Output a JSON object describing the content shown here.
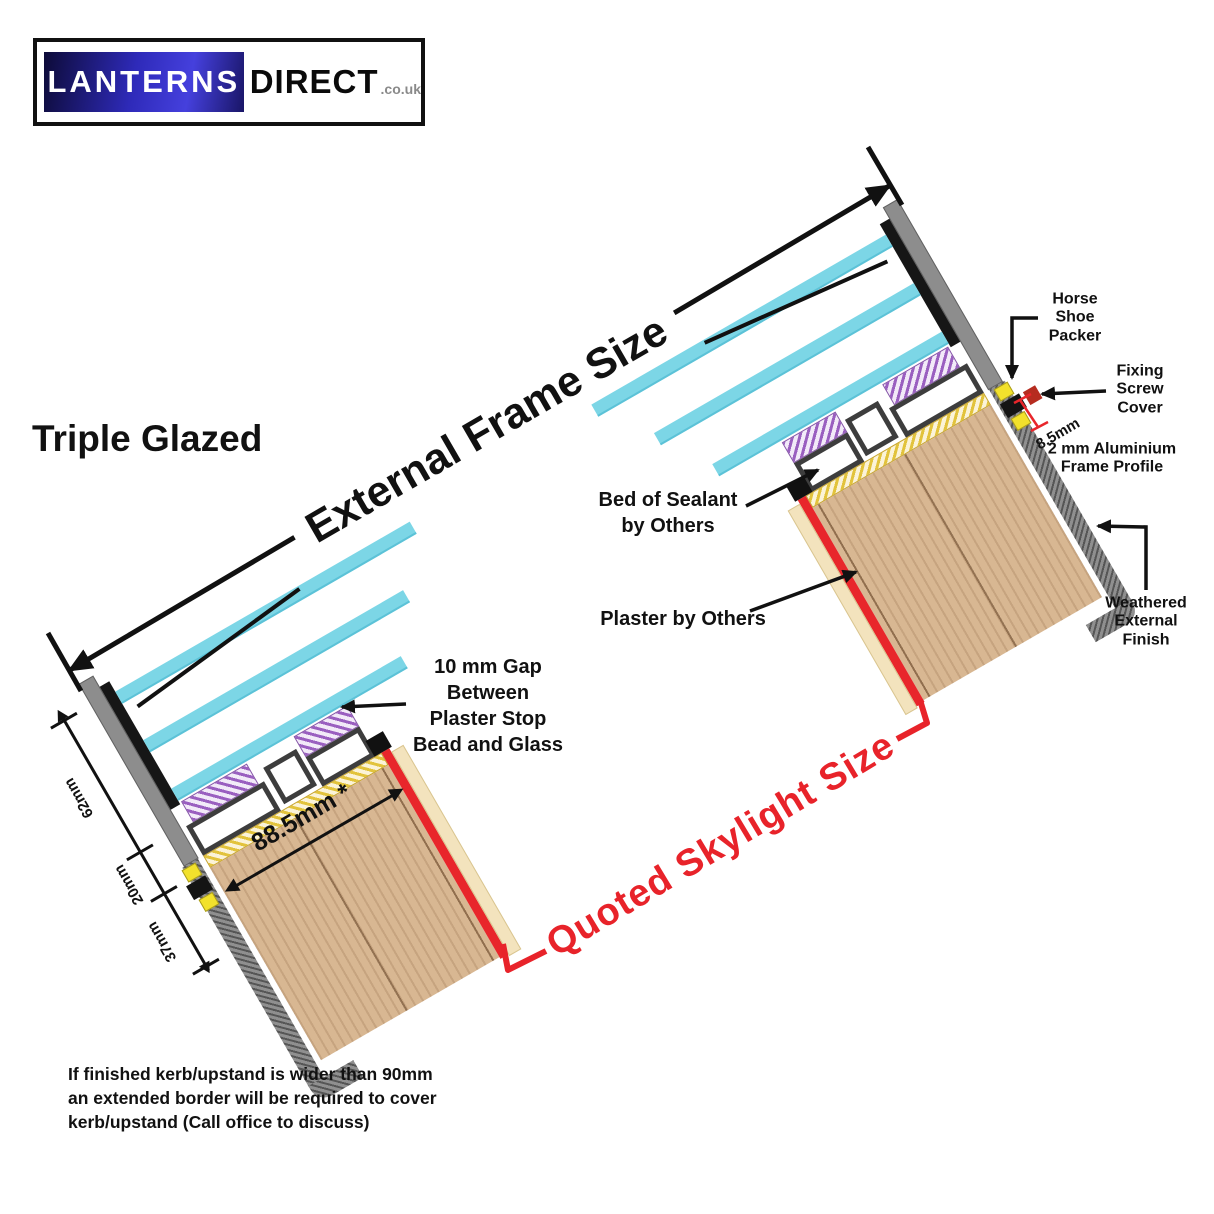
{
  "logo": {
    "brand_primary": "LANTERNS",
    "brand_secondary": "DIRECT",
    "brand_suffix": ".co.uk"
  },
  "headline": {
    "glazing_type": "Triple Glazed"
  },
  "dimensions": {
    "external_frame_size": "External Frame Size",
    "quoted_skylight_size": "Quoted Skylight Size",
    "glass_unit_height": "62mm",
    "frame_profile_height": "20mm",
    "upstand_depth": "37mm",
    "kerb_width": "88.5mm *",
    "profile_offset": "8.5mm"
  },
  "annotations": {
    "horse_shoe_packer": {
      "lines": [
        "Horse",
        "Shoe",
        "Packer"
      ]
    },
    "fixing_screw_cover": {
      "lines": [
        "Fixing",
        "Screw",
        "Cover"
      ]
    },
    "aluminium_frame_profile": {
      "lines": [
        "2 mm Aluminium",
        "Frame Profile"
      ]
    },
    "bed_of_sealant": {
      "lines": [
        "Bed of Sealant",
        "by Others"
      ]
    },
    "plaster_by_others": {
      "lines": [
        "Plaster by Others"
      ]
    },
    "weathered_external_finish": {
      "lines": [
        "Weathered",
        "External",
        "Finish"
      ]
    },
    "plaster_gap": {
      "lines": [
        "10 mm Gap",
        "Between",
        "Plaster Stop",
        "Bead and Glass"
      ]
    }
  },
  "footnote": {
    "lines": [
      "If finished kerb/upstand is wider than 90mm",
      "an extended border will be required to cover",
      "kerb/upstand (Call office to discuss)"
    ]
  },
  "colors": {
    "accent_red": "#e8262b",
    "glass_cyan": "#7cd6e6",
    "wood_tan": "#d8b792",
    "gasket_purple": "#9a5fc0",
    "sealant_yellow": "#e2c33c",
    "frame_grey": "#8d8d8d",
    "line_black": "#111111",
    "logo_blue": "#2e2ab9"
  }
}
